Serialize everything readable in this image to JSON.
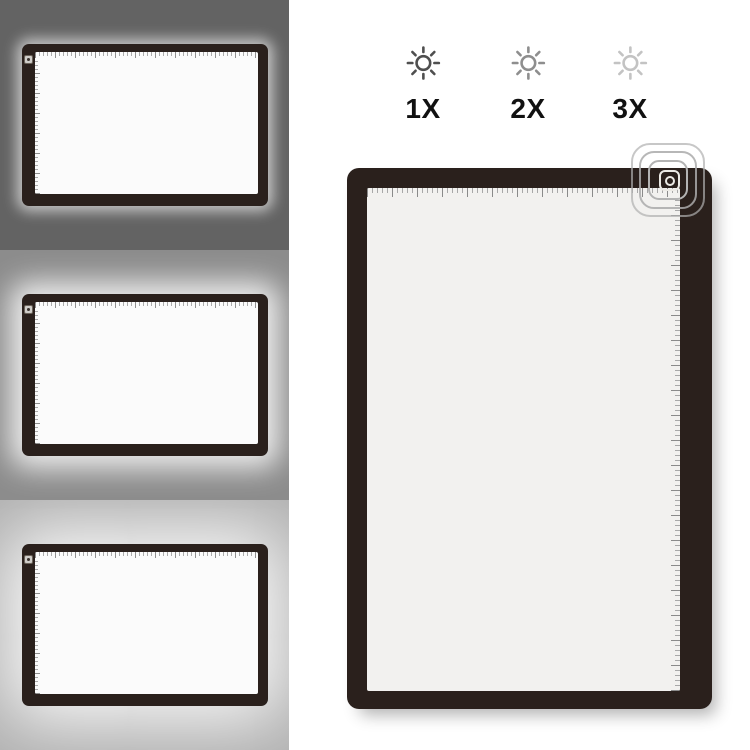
{
  "page": {
    "background": "#ffffff"
  },
  "brightness_scale": {
    "label_color": "#111111",
    "levels": [
      {
        "label": "1X",
        "icon": "sun-brightness-icon",
        "icon_color": "#4f4f4f"
      },
      {
        "label": "2X",
        "icon": "sun-brightness-icon",
        "icon_color": "#8e8e8e"
      },
      {
        "label": "3X",
        "icon": "sun-brightness-icon",
        "icon_color": "#c3c3c3"
      }
    ]
  },
  "preview_panels": [
    {
      "name": "brightness-1x-preview",
      "background": "#636363",
      "glow": "low"
    },
    {
      "name": "brightness-2x-preview",
      "background": "#8c8c8c",
      "glow": "medium"
    },
    {
      "name": "brightness-3x-preview",
      "background": "#b0b0b0",
      "glow": "high"
    }
  ],
  "light_pad": {
    "frame_color": "#2a201c",
    "screen_color": "#f2f1ef",
    "small_screen_color": "#fbfbfb",
    "ripple_ring_color": "#b3b3b3",
    "power_button_color": "#eceae5"
  }
}
